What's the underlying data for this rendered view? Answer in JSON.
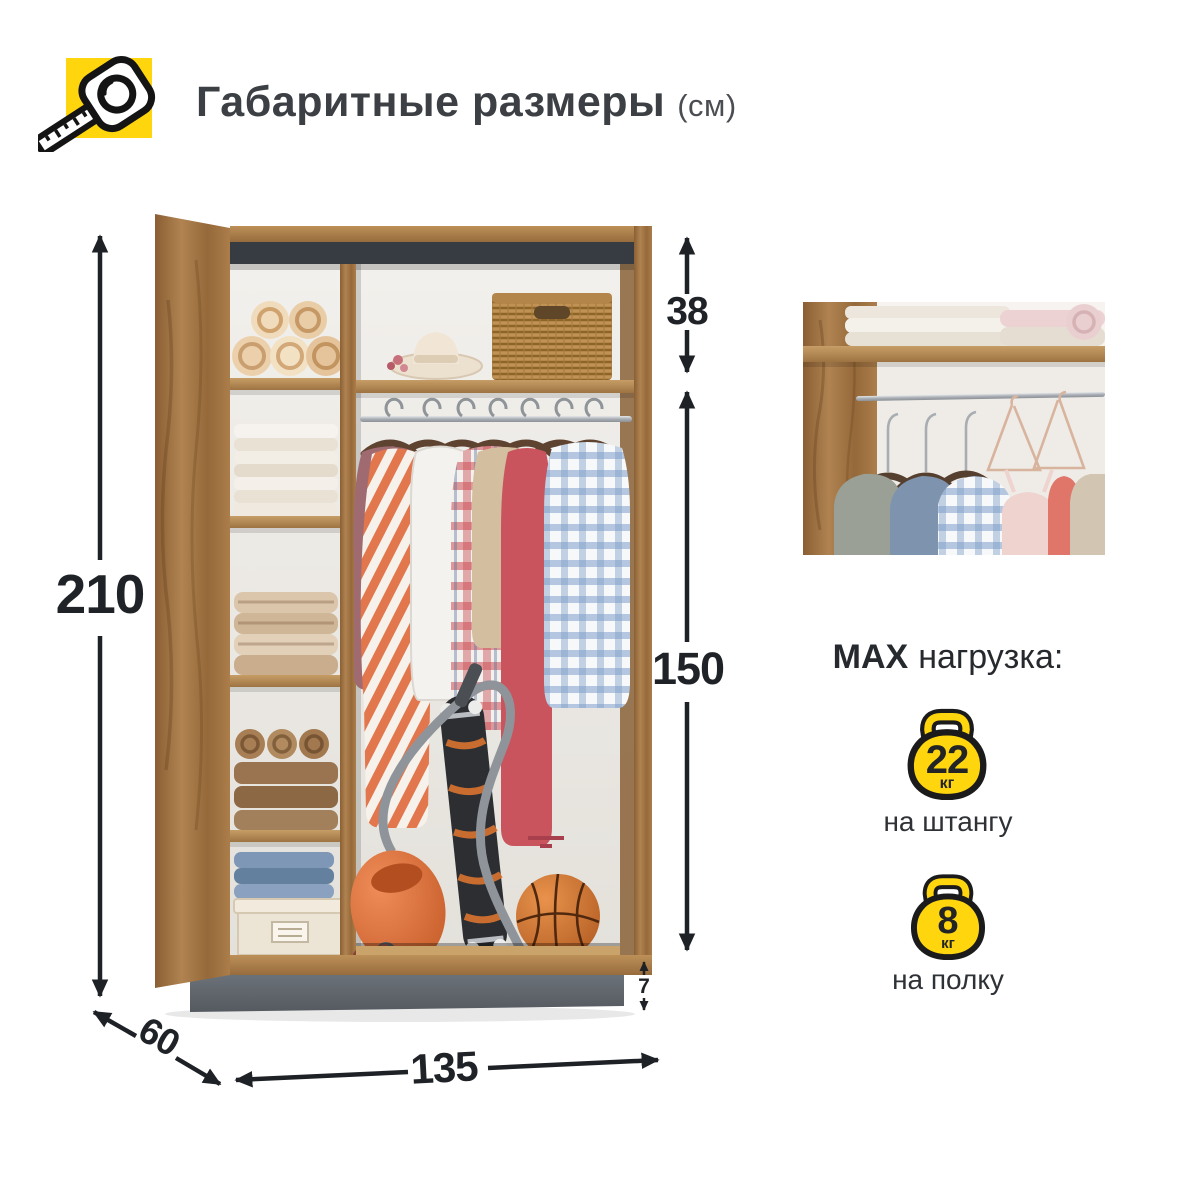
{
  "header": {
    "title": "Габаритные размеры",
    "unit": "(см)"
  },
  "dimensions": {
    "height": "210",
    "top_shelf_height": "38",
    "hanging_height": "150",
    "plinth_height": "7",
    "depth": "60",
    "width": "135"
  },
  "max_load": {
    "heading_max": "MAX",
    "heading_rest": "нагрузка:",
    "items": [
      {
        "value": "22",
        "unit": "кг",
        "label": "на штангу"
      },
      {
        "value": "8",
        "unit": "кг",
        "label": "на полку"
      }
    ]
  },
  "icons": {
    "title_icon": "tape-measure-icon",
    "load_icon": "kettlebell-icon"
  },
  "colors": {
    "accent_yellow": "#FFD60E",
    "wood": "#A87C4C",
    "dark_trim": "#3A3F45",
    "plinth_gray": "#61676D",
    "text_dark": "#1F2226"
  }
}
